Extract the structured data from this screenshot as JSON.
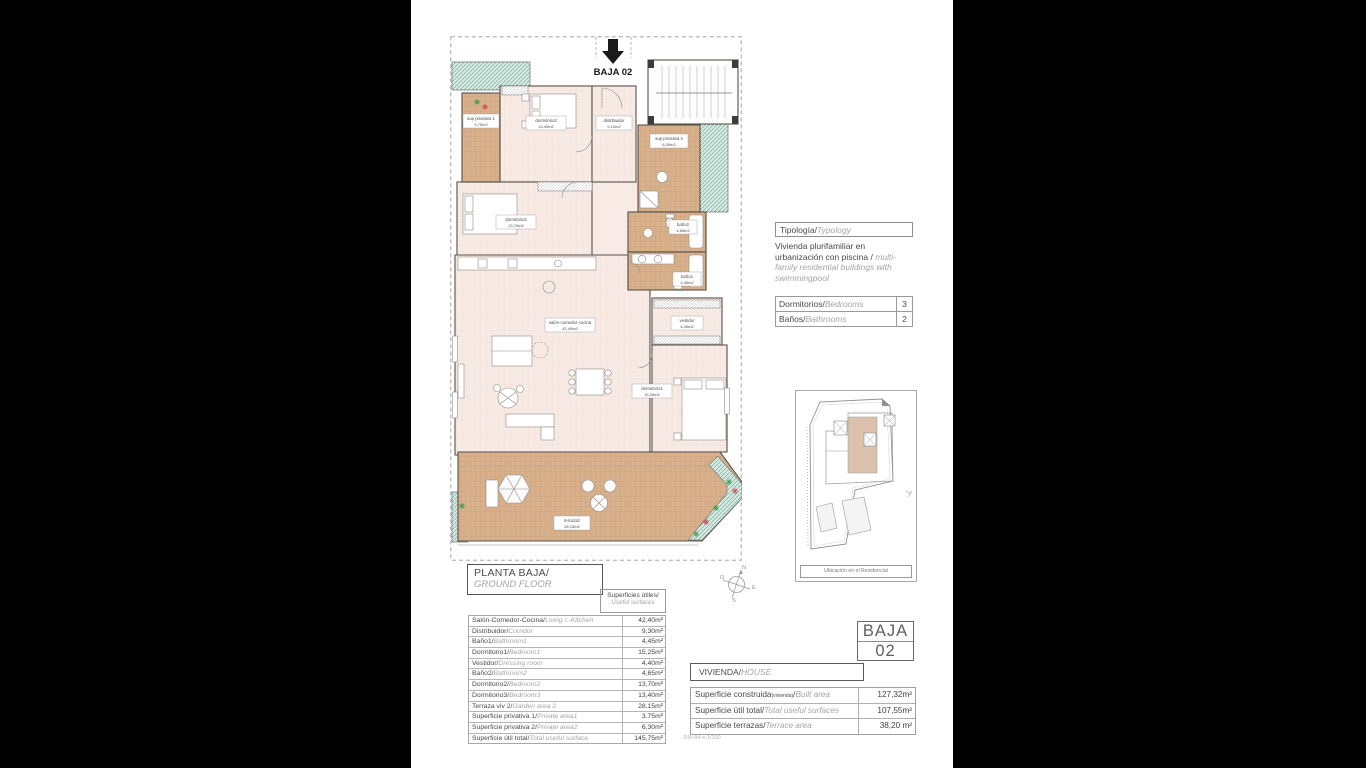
{
  "plan": {
    "marker_label": "BAJA 02",
    "rooms": [
      {
        "label": "sup privativa 1",
        "area": "3,70m2"
      },
      {
        "label": "dormitorio3",
        "area": "13,40m2"
      },
      {
        "label": "distribuidor",
        "area": "9,10m2"
      },
      {
        "label": "sup privativa 2",
        "area": "6,30m2"
      },
      {
        "label": "dormitorio2",
        "area": "13,70m2"
      },
      {
        "label": "baño2",
        "area": "4,65m2"
      },
      {
        "label": "baño1",
        "area": "4,45m2"
      },
      {
        "label": "salón-comedor-cocina",
        "area": "42,40m2"
      },
      {
        "label": "vestidor",
        "area": "4,40m2"
      },
      {
        "label": "dormitorio1",
        "area": "15,25m2"
      },
      {
        "label": "terraza2",
        "area": "28,15m2"
      }
    ],
    "compass": {
      "n": "N",
      "e": "E",
      "s": "S",
      "o": "O"
    }
  },
  "typology": {
    "header_es": "Tipología/",
    "header_en": "Typology",
    "body_es": "Vivienda plurifamiliar en urbanización con piscina  /",
    "body_en": "multi-family residential buildings with swimmingpool"
  },
  "counts": {
    "rows": [
      {
        "es": "Dormitorios/",
        "en": "Bedrooms",
        "value": "3"
      },
      {
        "es": "Baños/",
        "en": "Bathrooms",
        "value": "2"
      }
    ]
  },
  "location_map": {
    "caption": "Ubicación en el Residencial"
  },
  "title_block": {
    "es": "PLANTA BAJA/",
    "en": "GROUND FLOOR"
  },
  "surfaces": {
    "header_es": "Superficies útiles/",
    "header_en": "Useful surfaces",
    "rows": [
      {
        "es": "Salón-Comedor-Cocina/",
        "en": "Living r.-Kitchen",
        "value": "42,40m²"
      },
      {
        "es": "Distribuidor/",
        "en": "Corridor",
        "value": "9,30m²"
      },
      {
        "es": "Baño1/",
        "en": "Bathroom1",
        "value": "4,45m²"
      },
      {
        "es": "Dormitorio1/",
        "en": "Bedroom1",
        "value": "15,25m²"
      },
      {
        "es": "Vestidor/",
        "en": "Dressing room",
        "value": "4,40m²"
      },
      {
        "es": "Baño2/",
        "en": "Bathroom2",
        "value": "4,65m²"
      },
      {
        "es": "Dormitorio2/",
        "en": "Bedroom2",
        "value": "13,70m²"
      },
      {
        "es": "Dormitorio3/",
        "en": "Bedroom3",
        "value": "13,40m²"
      },
      {
        "es": "Terraza viv 2/",
        "en": "Garden area 2",
        "value": "28,15m²"
      },
      {
        "es": "Superficie privativa 1/",
        "en": "Private area1",
        "value": "3,75m²"
      },
      {
        "es": "Superficie privativa 2/",
        "en": "Private area2",
        "value": "6,30m²"
      },
      {
        "es": "Superficie útil total/",
        "en": "Total useful surface",
        "value": "145,75m²"
      }
    ]
  },
  "unit_badge": {
    "line1": "BAJA",
    "line2": "02"
  },
  "vivienda": {
    "es": "VIVIENDA/",
    "en": "HOUSE"
  },
  "summary": {
    "rows": [
      {
        "es": "Superficie construida",
        "note": "(vivienda)",
        "sep": "/",
        "en": "Built area",
        "value": "127,32m²"
      },
      {
        "es": "Superficie útil total",
        "note": "",
        "sep": "/",
        "en": "Total useful surfaces",
        "value": "107,55m²"
      },
      {
        "es": "Superficie terrazas",
        "note": "",
        "sep": "/",
        "en": "Terrace area",
        "value": "38,20 m²"
      }
    ]
  },
  "footer": {
    "scale": "DIN A4  e:1/100"
  }
}
